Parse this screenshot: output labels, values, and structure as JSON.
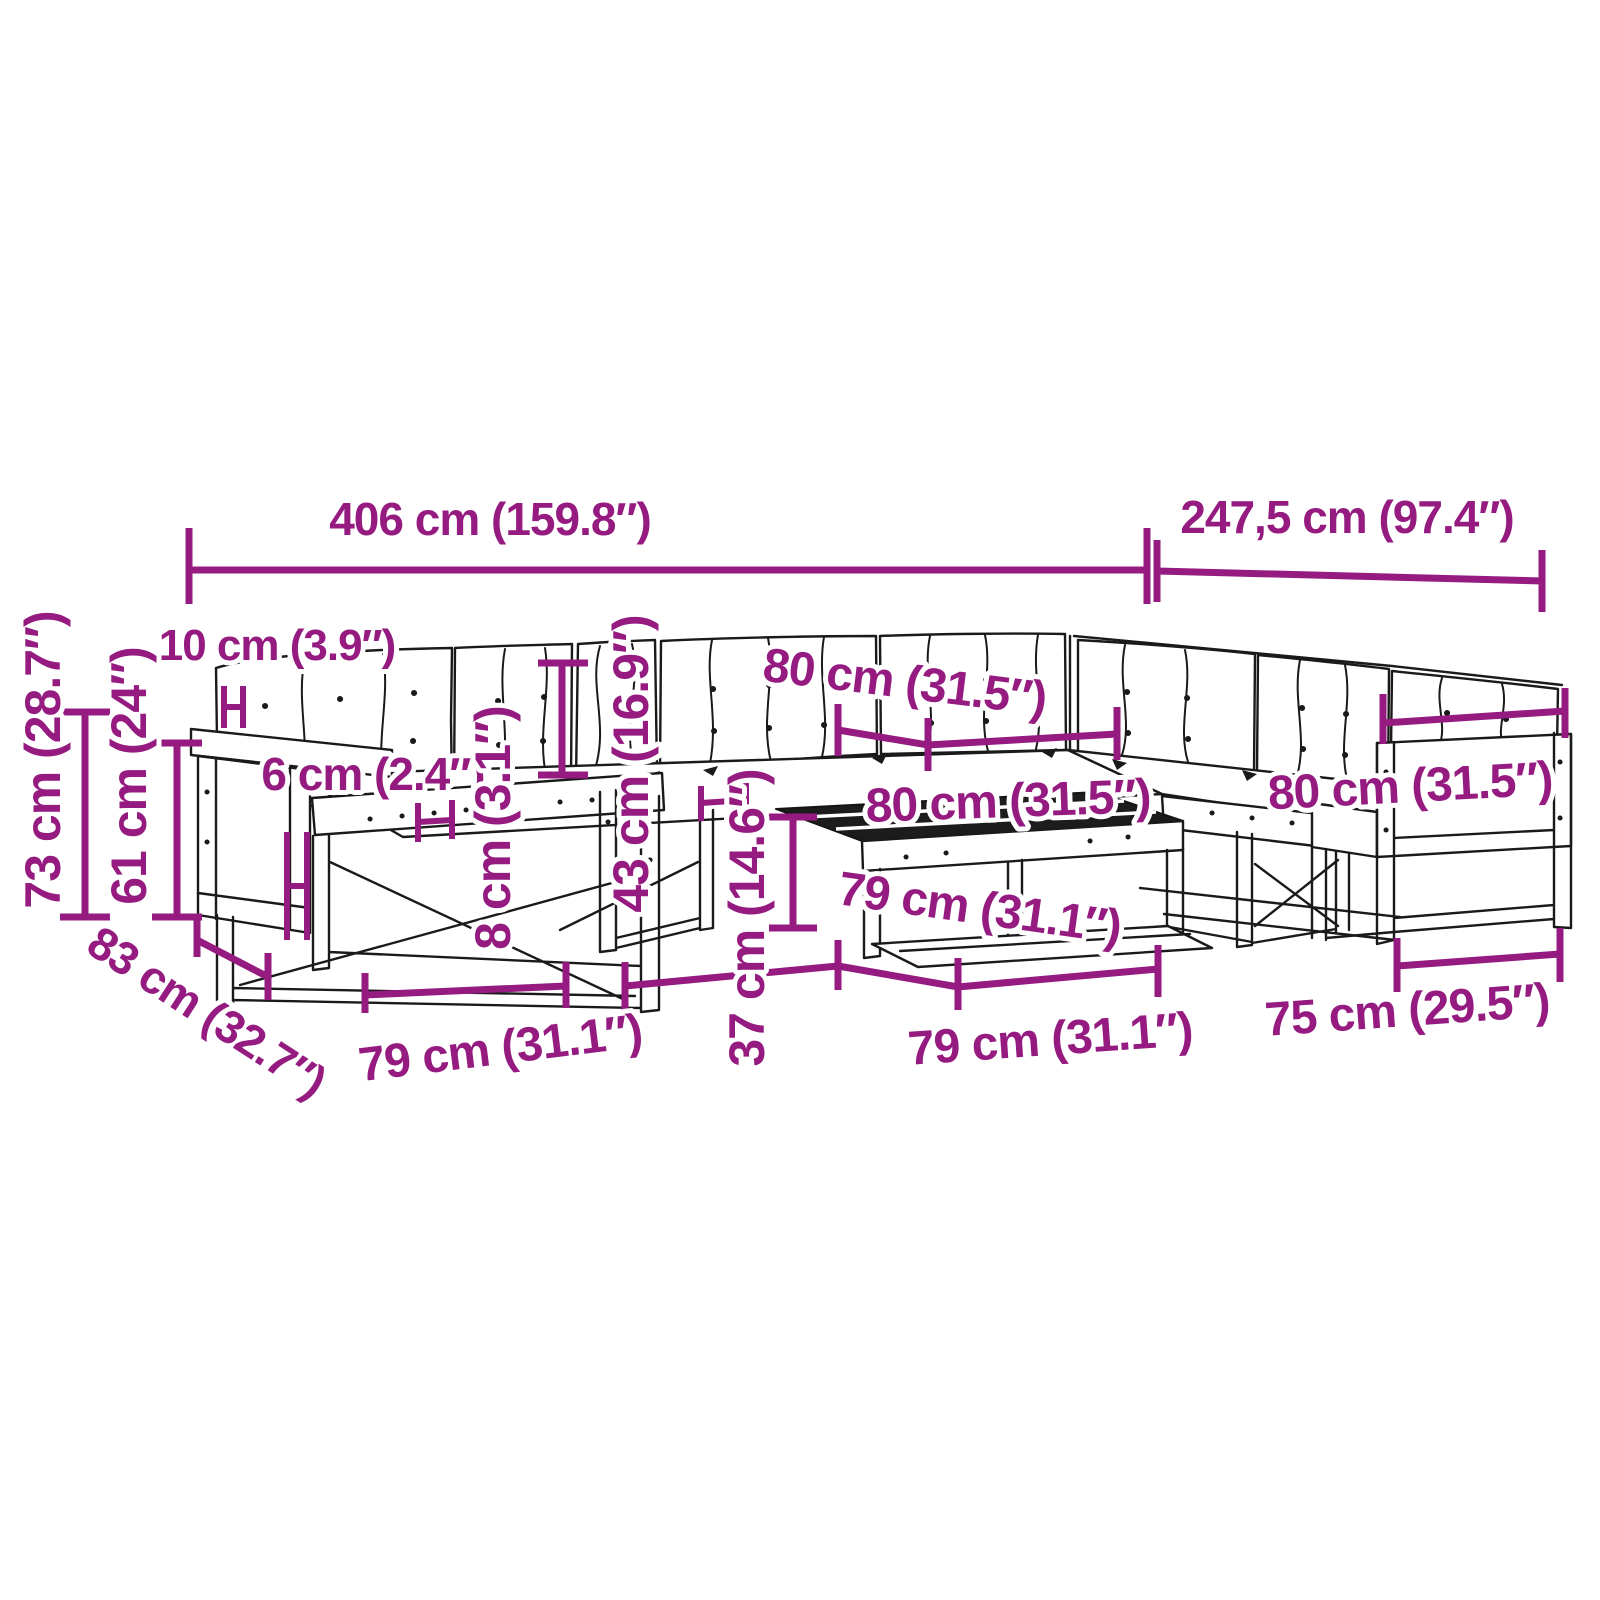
{
  "diagram": {
    "accent_color": "#951b81",
    "line_color": "#1a1a1a",
    "background": "#ffffff"
  },
  "labels": {
    "total_width": "406 cm (159.8″)",
    "total_depth": "247,5 cm (97.4″)",
    "total_height": "73 cm (28.7″)",
    "armrest_height": "61 cm (24″)",
    "back_cushion_thickness": "10 cm (3.9″)",
    "seat_cushion_thickness": "6 cm (2.4″)",
    "seat_board_thickness": "8 cm (3.1″)",
    "back_cushion_height": "43 cm (16.9″)",
    "table_height": "37 cm (14.6″)",
    "module_width_back": "80 cm (31.5″)",
    "module_width_middle": "80 cm (31.5″)",
    "module_width_right": "80 cm (31.5″)",
    "module_depth_front": "79 cm (31.1″)",
    "table_side_length": "79 cm (31.1″)",
    "table_front_length": "79 cm (31.1″)",
    "corner_module_depth": "83 cm (32.7″)",
    "end_module_width": "75 cm (29.5″)"
  }
}
